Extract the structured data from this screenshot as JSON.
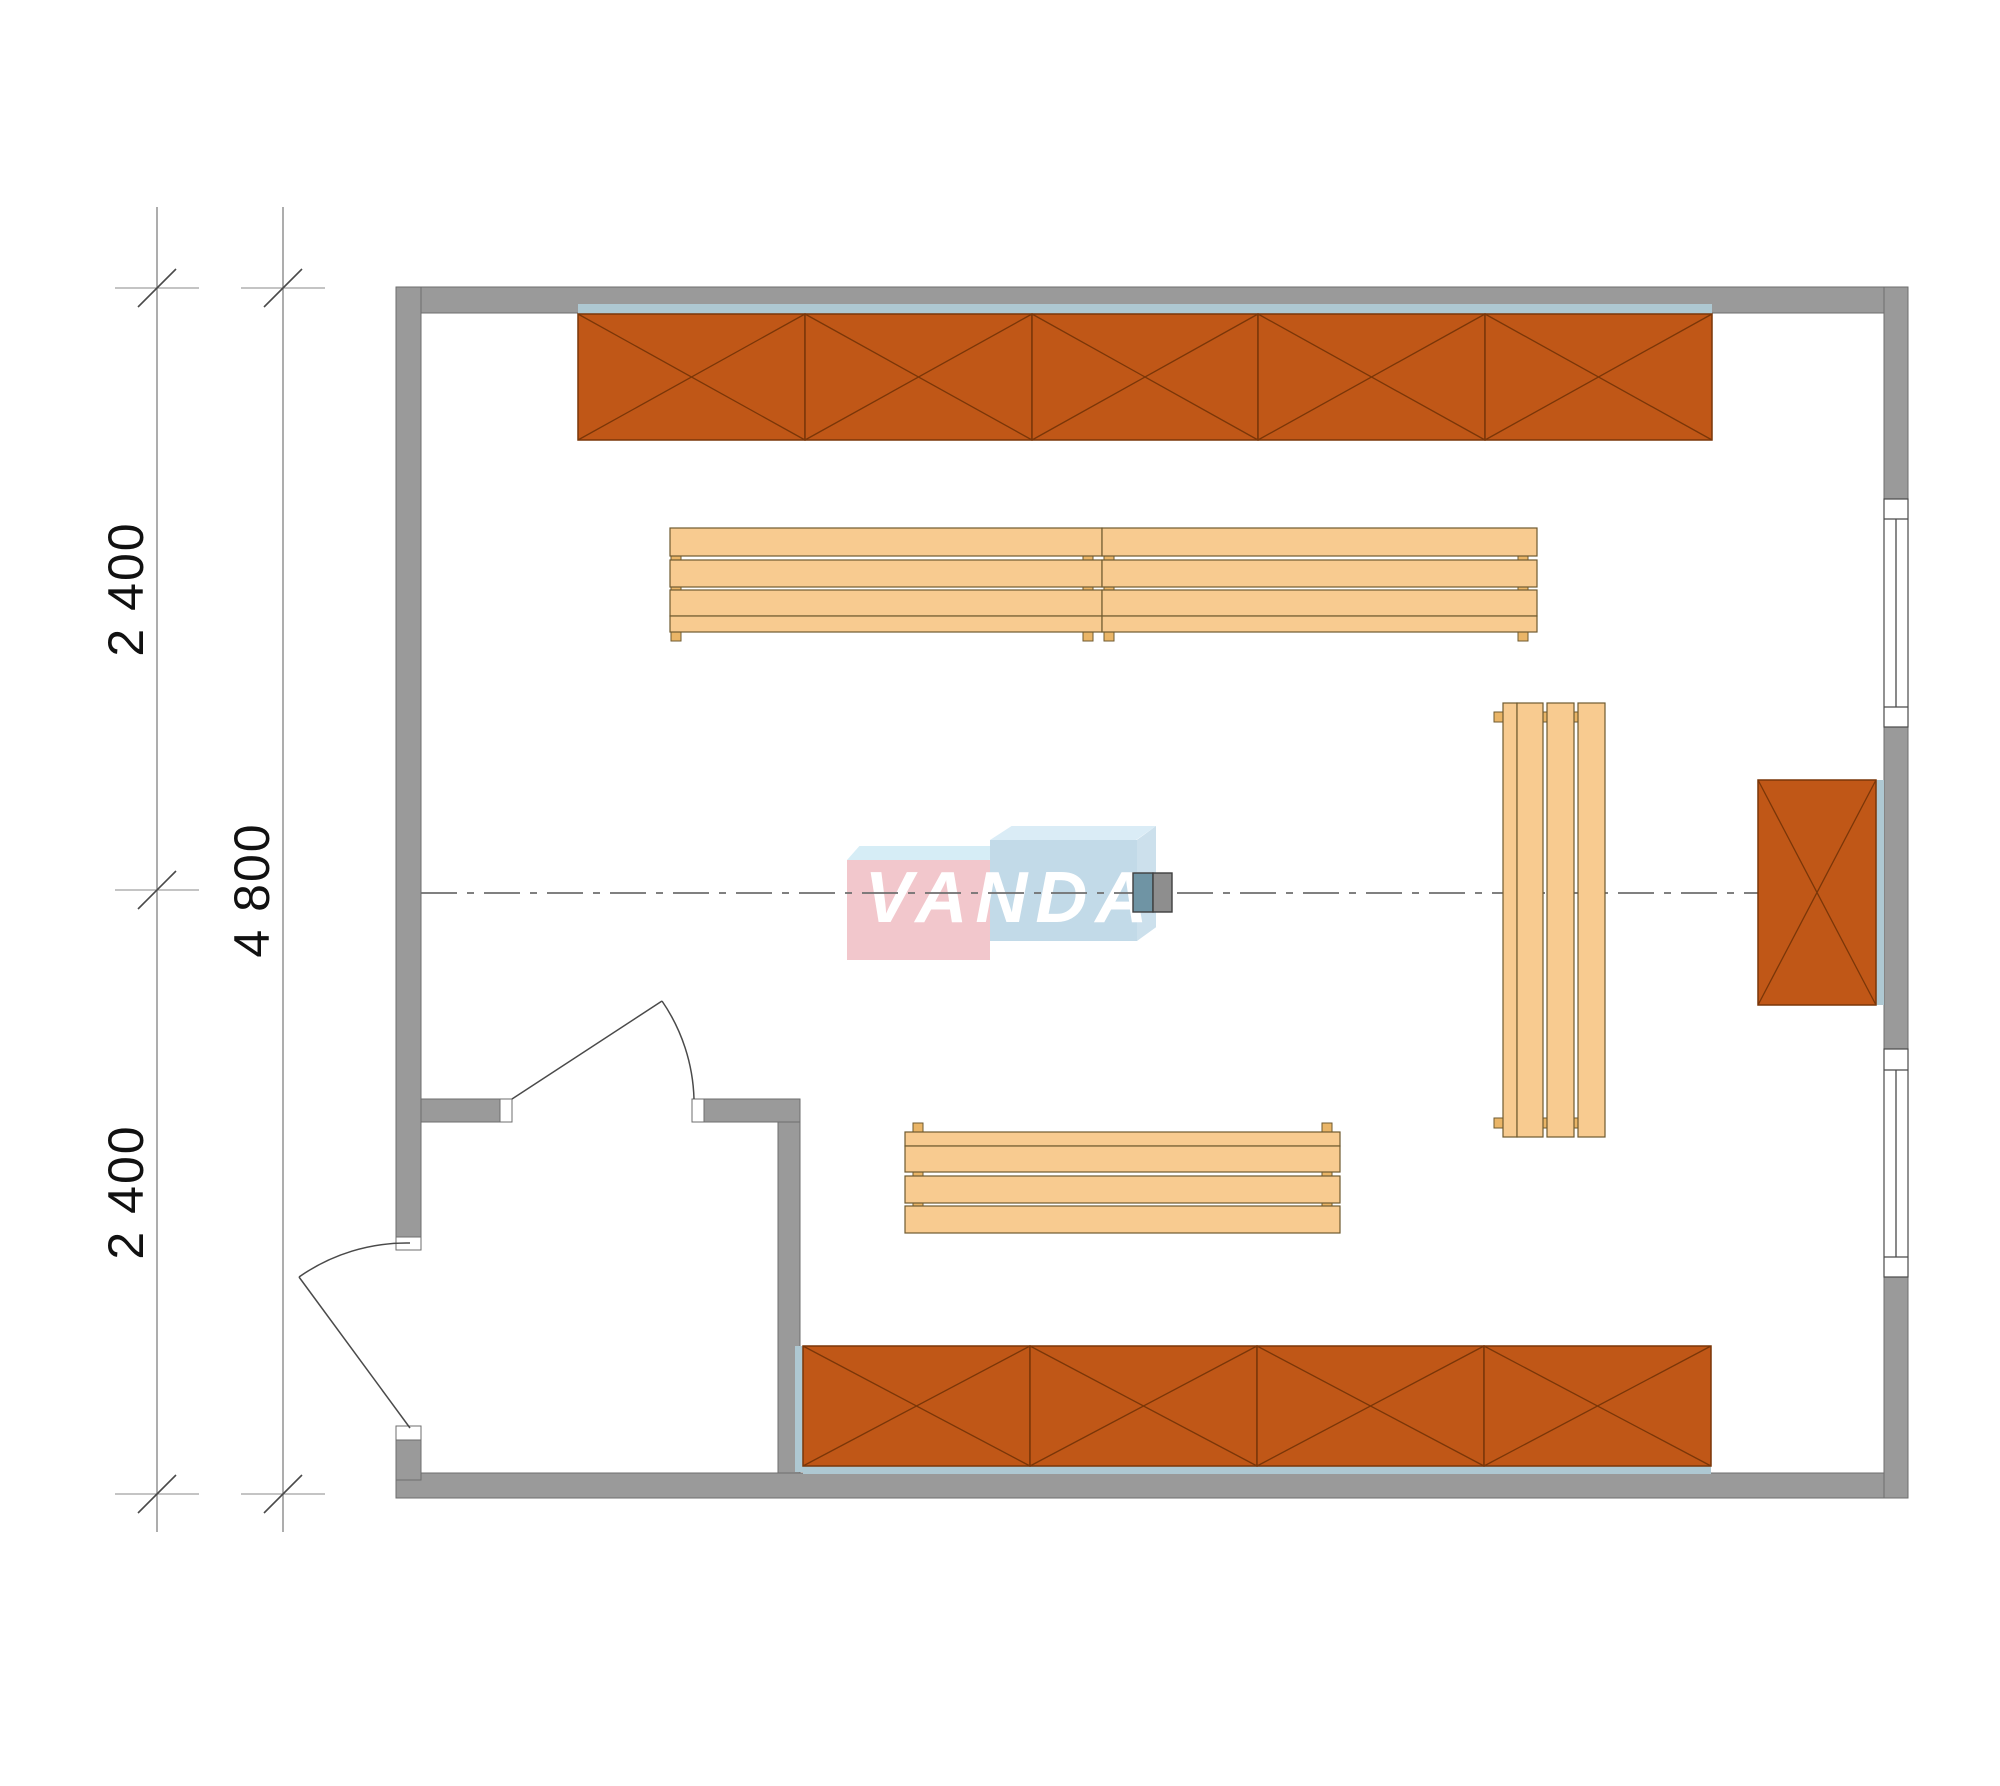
{
  "title": "VANDA room floor plan",
  "dimensions": {
    "vertical_segments": [
      "2 400",
      "2 400"
    ],
    "vertical_total": "4 800",
    "unit": "mm"
  },
  "watermark": {
    "text": "VANDA"
  },
  "plan": {
    "top_shelf_sections": 5,
    "bottom_shelf_sections": 4,
    "right_cabinet_sections": 1,
    "benches": 3,
    "doors": 2,
    "windows": 2
  },
  "colors": {
    "wall": "#9a9a9a",
    "wall_edge": "#6e6e6e",
    "line": "#4a4a4a",
    "dim": "#8a8a8a",
    "center": "#6f6f6f",
    "text": "#111111",
    "shelf_orange": "#c05717",
    "shelf_line": "#7a3608",
    "bench_tan": "#f8cb90",
    "bench_line": "#6f5a2f",
    "bench_foot": "#eab567",
    "back_panel": "#aec8d2",
    "column_left": "#6f94a4",
    "column_right": "#8e8e8e",
    "logo_pink": "#f2c5ca",
    "logo_pink_top": "#d5edf6",
    "logo_blue": "#c0d9e8",
    "logo_blue_top": "#d9ecf6",
    "logo_blue_side": "#cadfec",
    "logo_text": "#ffffff"
  }
}
